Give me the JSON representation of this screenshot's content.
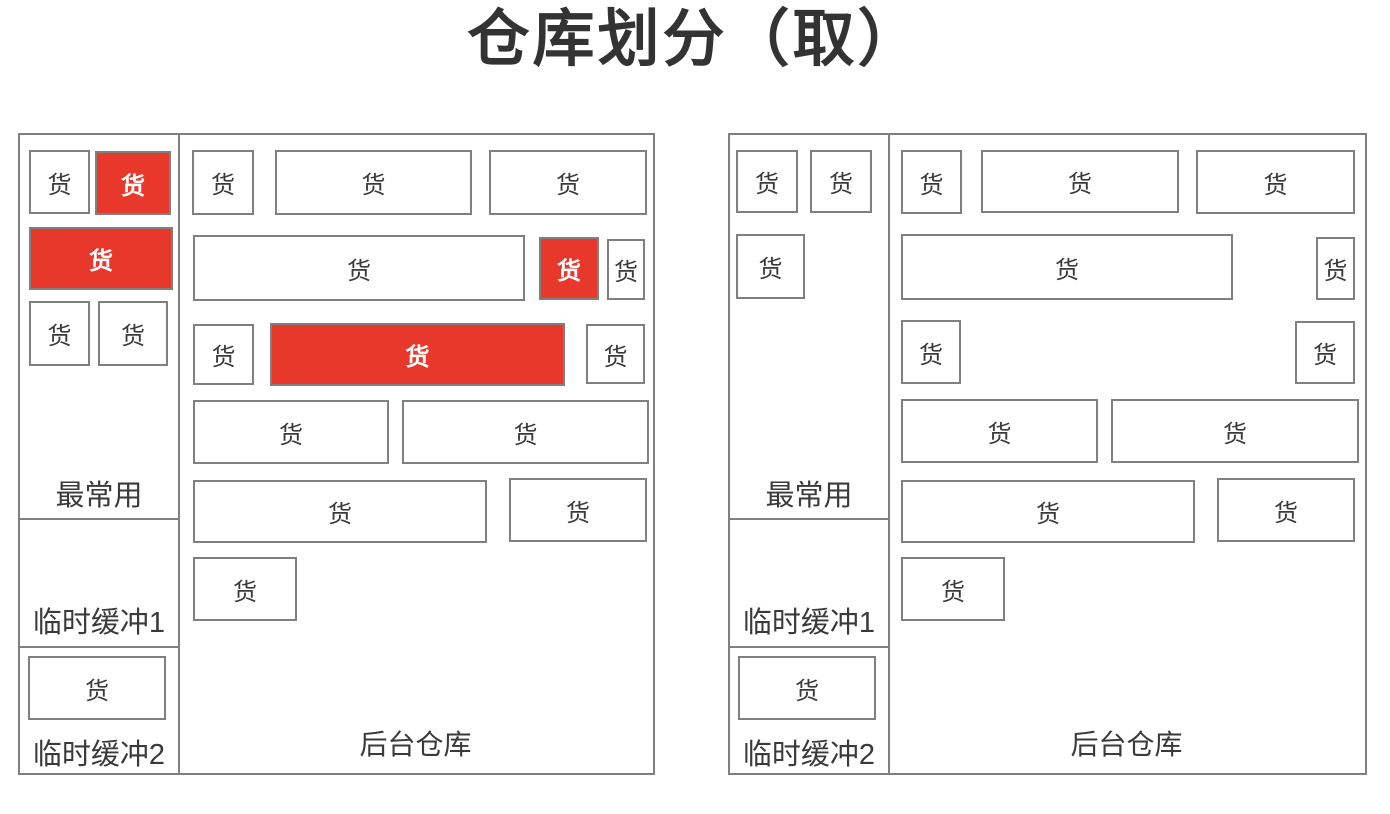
{
  "title": "仓库划分（取）",
  "labels": {
    "cargo": "货",
    "most_used": "最常用",
    "buffer1": "临时缓冲1",
    "buffer2": "临时缓冲2",
    "back_warehouse": "后台仓库"
  },
  "colors": {
    "highlight_red": "#E8382B",
    "border_gray": "#808080",
    "text_dark": "#3A3A3A"
  },
  "panels": [
    {
      "name": "before-picking",
      "sidebar_boxes": [
        {
          "x": 9,
          "y": 15,
          "w": 61,
          "h": 64,
          "red": false
        },
        {
          "x": 75,
          "y": 16,
          "w": 76,
          "h": 64,
          "red": true
        },
        {
          "x": 9,
          "y": 92,
          "w": 144,
          "h": 63,
          "red": true
        },
        {
          "x": 9,
          "y": 166,
          "w": 61,
          "h": 65,
          "red": false
        },
        {
          "x": 78,
          "y": 166,
          "w": 70,
          "h": 65,
          "red": false
        }
      ],
      "buffer2_boxes": [
        {
          "x": 8,
          "y": 521,
          "w": 138,
          "h": 64,
          "red": false
        }
      ],
      "main_boxes": [
        {
          "x": 172,
          "y": 15,
          "w": 62,
          "h": 65,
          "red": false
        },
        {
          "x": 255,
          "y": 15,
          "w": 197,
          "h": 65,
          "red": false
        },
        {
          "x": 469,
          "y": 15,
          "w": 158,
          "h": 65,
          "red": false
        },
        {
          "x": 173,
          "y": 100,
          "w": 332,
          "h": 66,
          "red": false
        },
        {
          "x": 519,
          "y": 102,
          "w": 60,
          "h": 63,
          "red": true
        },
        {
          "x": 587,
          "y": 104,
          "w": 38,
          "h": 61,
          "red": false
        },
        {
          "x": 173,
          "y": 189,
          "w": 61,
          "h": 61,
          "red": false
        },
        {
          "x": 250,
          "y": 188,
          "w": 295,
          "h": 63,
          "red": true
        },
        {
          "x": 566,
          "y": 189,
          "w": 59,
          "h": 60,
          "red": false
        },
        {
          "x": 173,
          "y": 265,
          "w": 196,
          "h": 64,
          "red": false
        },
        {
          "x": 382,
          "y": 265,
          "w": 247,
          "h": 64,
          "red": false
        },
        {
          "x": 173,
          "y": 345,
          "w": 294,
          "h": 63,
          "red": false
        },
        {
          "x": 489,
          "y": 343,
          "w": 138,
          "h": 64,
          "red": false
        },
        {
          "x": 173,
          "y": 422,
          "w": 104,
          "h": 64,
          "red": false
        }
      ]
    },
    {
      "name": "after-picking",
      "sidebar_boxes": [
        {
          "x": 6,
          "y": 15,
          "w": 62,
          "h": 63,
          "red": false
        },
        {
          "x": 80,
          "y": 15,
          "w": 62,
          "h": 63,
          "red": false
        },
        {
          "x": 6,
          "y": 99,
          "w": 69,
          "h": 65,
          "red": false
        }
      ],
      "buffer2_boxes": [
        {
          "x": 8,
          "y": 521,
          "w": 138,
          "h": 64,
          "red": false
        }
      ],
      "main_boxes": [
        {
          "x": 171,
          "y": 15,
          "w": 61,
          "h": 64,
          "red": false
        },
        {
          "x": 251,
          "y": 15,
          "w": 198,
          "h": 63,
          "red": false
        },
        {
          "x": 466,
          "y": 15,
          "w": 159,
          "h": 64,
          "red": false
        },
        {
          "x": 171,
          "y": 99,
          "w": 332,
          "h": 66,
          "red": false
        },
        {
          "x": 586,
          "y": 102,
          "w": 39,
          "h": 63,
          "red": false
        },
        {
          "x": 171,
          "y": 185,
          "w": 60,
          "h": 64,
          "red": false
        },
        {
          "x": 565,
          "y": 186,
          "w": 60,
          "h": 63,
          "red": false
        },
        {
          "x": 171,
          "y": 264,
          "w": 197,
          "h": 64,
          "red": false
        },
        {
          "x": 381,
          "y": 264,
          "w": 248,
          "h": 64,
          "red": false
        },
        {
          "x": 171,
          "y": 345,
          "w": 294,
          "h": 63,
          "red": false
        },
        {
          "x": 487,
          "y": 343,
          "w": 138,
          "h": 64,
          "red": false
        },
        {
          "x": 171,
          "y": 422,
          "w": 104,
          "h": 64,
          "red": false
        }
      ]
    }
  ]
}
